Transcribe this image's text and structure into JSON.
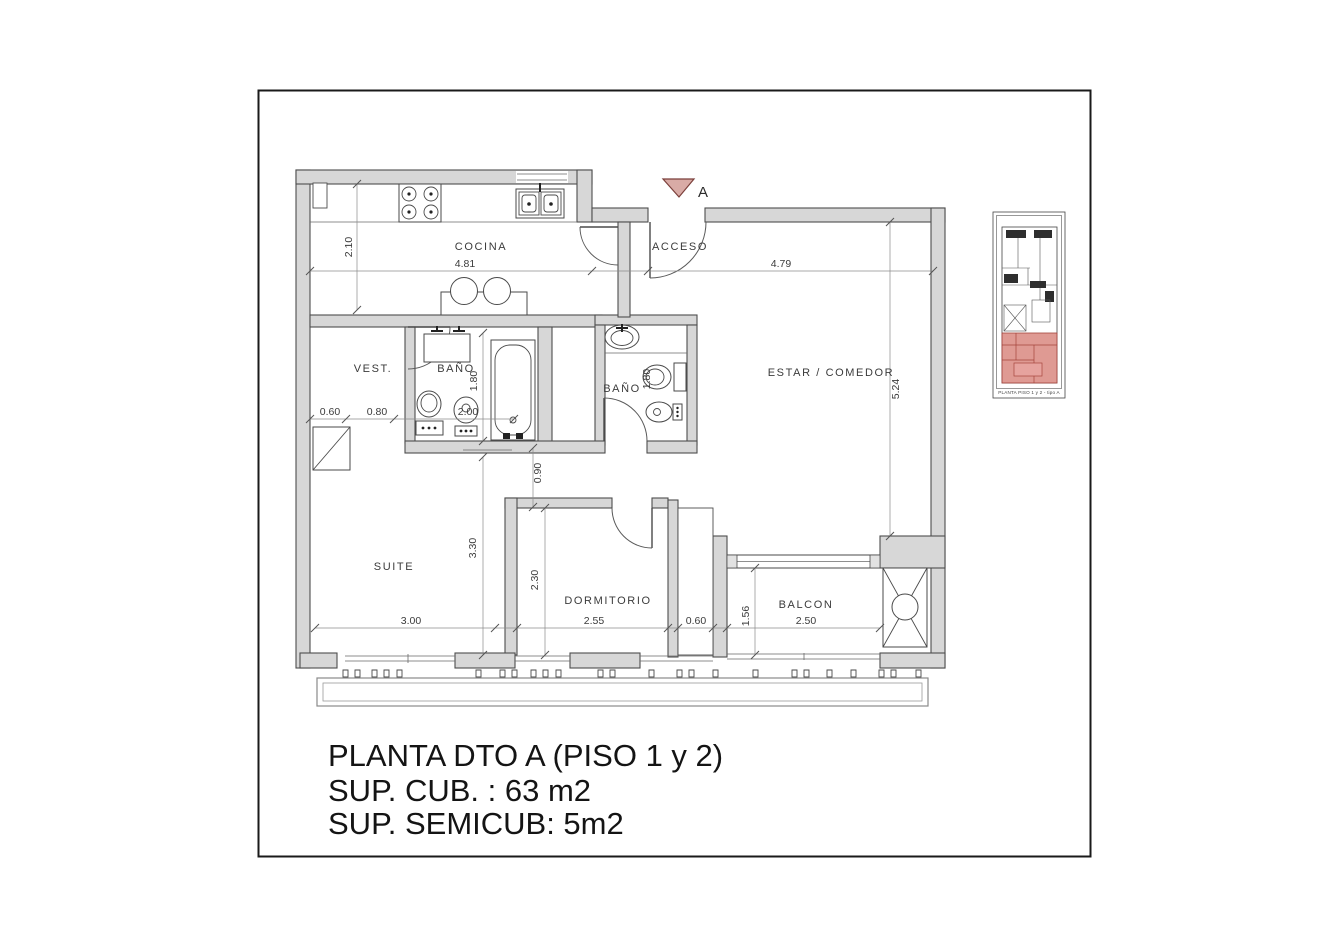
{
  "title_block": {
    "line1": "PLANTA DTO A (PISO 1 y 2)",
    "line2": "SUP. CUB. : 63 m2",
    "line3": "SUP. SEMICUB: 5m2"
  },
  "rooms": {
    "kitchen": "COCINA",
    "entry": "ACCESO",
    "dressing": "VEST.",
    "bath_main": "BAÑO",
    "bath_second": "BAÑO",
    "living": "ESTAR / COMEDOR",
    "suite": "SUITE",
    "bedroom": "DORMITORIO",
    "balcony": "BALCON"
  },
  "dimensions": {
    "kitchen_width": "4.81",
    "kitchen_depth": "2.10",
    "living_width": "4.79",
    "living_height": "5.24",
    "dressing_seg1": "0.60",
    "dressing_seg2": "0.80",
    "bath_main_width": "2.00",
    "bath_main_depth": "1.80",
    "bath_second_depth": "1.80",
    "hall_width": "0.90",
    "suite_width": "3.00",
    "suite_depth": "3.30",
    "bedroom_width": "2.55",
    "bedroom_depth": "2.30",
    "duct_width": "0.60",
    "balcony_depth": "1.56",
    "balcony_width": "2.50"
  },
  "section_marker": {
    "label": "A"
  },
  "key_plan": {
    "caption": "PLANTA PISO 1 y 2 - tipo A"
  },
  "colors": {
    "wall_fill": "#d7d7d7",
    "line": "#4d4d4d",
    "marker_fill": "#d9aba6",
    "marker_stroke": "#7b3f3a",
    "keyplan_red": "#d98880",
    "text": "#141414"
  }
}
